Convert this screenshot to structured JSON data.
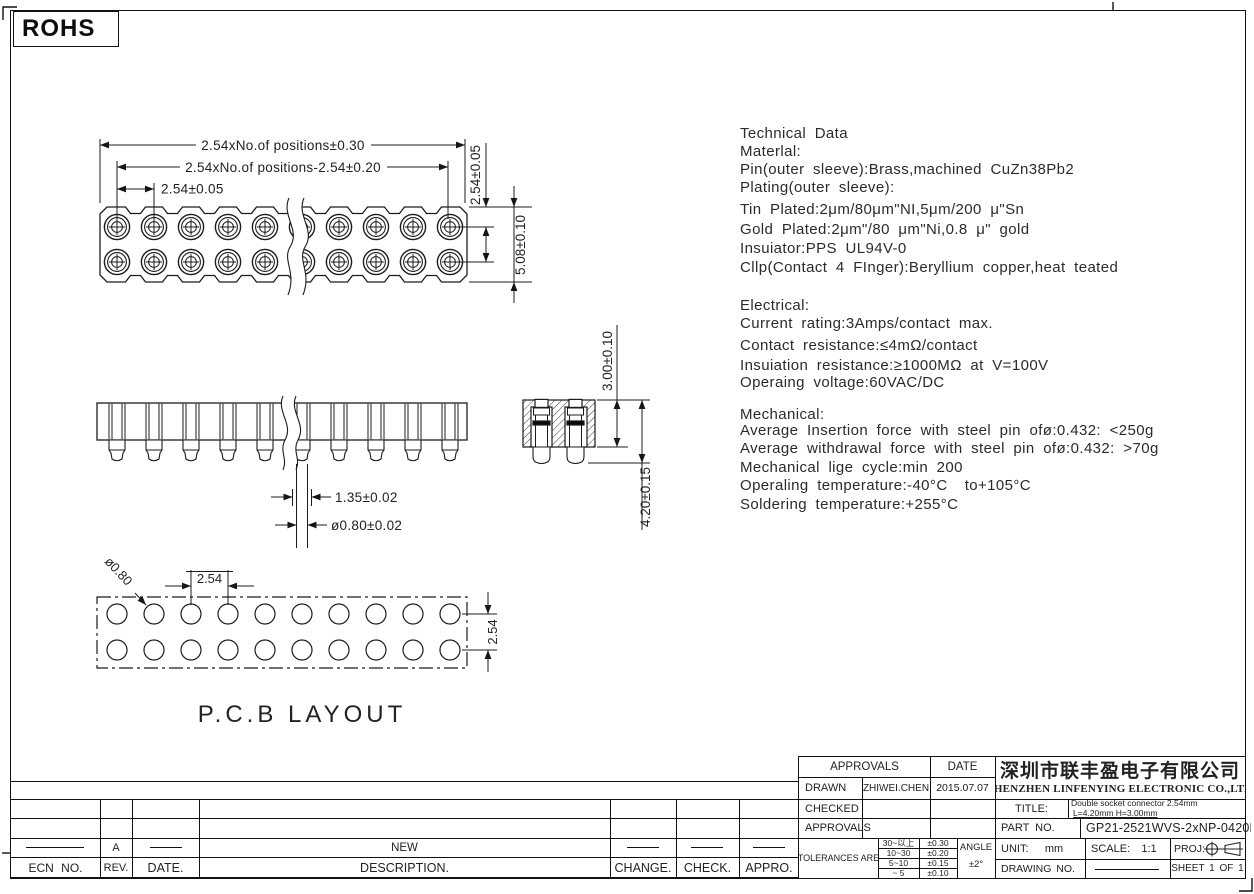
{
  "page": {
    "rohs_label": "ROHS"
  },
  "tech_data": {
    "lines": [
      "Technical Data",
      "Materlal:",
      "Pin(outer sleeve):Brass,machined CuZn38Pb2",
      "Plating(outer sleeve):",
      "Tin Plated:2μm/80μm\"NI,5μm/200 μ\"Sn",
      "Gold Plated:2μm\"/80 μm\"Ni,0.8 μ\" gold",
      "Insuiator:PPS UL94V-0",
      "Cllp(Contact 4 FInger):Beryllium copper,heat teated",
      "Electrical:",
      "Current rating:3Amps/contact max.",
      "Contact resistance:≤4mΩ/contact",
      "Insuiation resistance:≥1000MΩ at V=100V",
      "Operaing voltage:60VAC/DC",
      "Mechanical:",
      "Average Insertion force with steel pin ofø:0.432: <250g",
      "Average withdrawal force with steel pin ofø:0.432: >70g",
      "Mechanical lige cycle:min 200",
      "Operaling temperature:-40°C  to+105°C",
      "Soldering temperature:+255°C"
    ]
  },
  "drawings": {
    "top_view": {
      "dim_overall": "2.54xNo.of positions±0.30",
      "dim_inner": "2.54xNo.of positions-2.54±0.20",
      "dim_pitch": "2.54±0.05",
      "dim_row": "2.54±0.05",
      "dim_width": "5.08±0.10"
    },
    "front_view": {
      "dim_tip": "1.35±0.02",
      "dim_dia": "ø0.80±0.02"
    },
    "section_view": {
      "dim_height": "3.00±0.10",
      "dim_total": "4.20±0.15"
    },
    "pcb": {
      "label": "P.C.B LAYOUT",
      "dim_pitch": "2.54",
      "dim_hole": "ø0.80",
      "dim_row": "2.54"
    }
  },
  "revision_table": {
    "headers": [
      "ECN NO.",
      "REV.",
      "DATE.",
      "DESCRIPTION.",
      "CHANGE.",
      "CHECK.",
      "APPRO."
    ],
    "row": {
      "rev": "A",
      "description": "NEW"
    }
  },
  "title_block": {
    "approvals_header": "APPROVALS",
    "date_header": "DATE",
    "drawn_label": "DRAWN",
    "drawn_name": "ZHIWEI.CHEN",
    "drawn_date": "2015.07.07",
    "checked_label": "CHECKED",
    "approvals_label": "APPROVALS",
    "tolerances_label": "TOLERANCES ARE",
    "tolerances": [
      {
        "range": "30~以上",
        "value": "±0.30"
      },
      {
        "range": "10~30",
        "value": "±0.20"
      },
      {
        "range": "5~10",
        "value": "±0.15"
      },
      {
        "range": "~ 5",
        "value": "±0.10"
      }
    ],
    "angle_label": "ANGLE",
    "angle_value": "±2°",
    "company_cn": "深圳市联丰盈电子有限公司",
    "company_en": "SHENZHEN LINFENYING ELECTRONIC CO.,LTD",
    "title_label": "TITLE:",
    "title_line1": "Double socket connector 2.54mm",
    "title_line2": "L=4.20mm H=3.00mm",
    "part_label": "PART NO.",
    "part_no": "GP21-2521WVS-2xNP-0420B",
    "unit_label": "UNIT:",
    "unit_value": "mm",
    "scale_label": "SCALE:",
    "scale_value": "1:1",
    "proj_label": "PROJ:",
    "drawing_no_label": "DRAWING NO.",
    "sheet_label": "SHEET 1 OF 1"
  }
}
